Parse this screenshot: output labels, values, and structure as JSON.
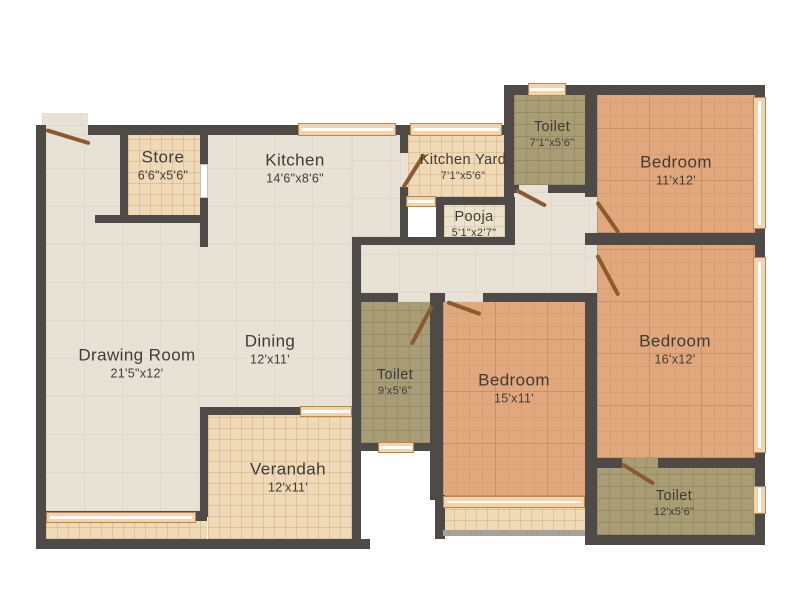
{
  "plan_title": "2BHK-style apartment floor plan",
  "rooms": [
    {
      "name": "Store",
      "dims": "6'6\"x5'6\""
    },
    {
      "name": "Kitchen",
      "dims": "14'6\"x8'6\""
    },
    {
      "name": "Kitchen Yard",
      "dims": "7'1\"x5'6\""
    },
    {
      "name": "Toilet",
      "dims": "7'1\"x5'6\""
    },
    {
      "name": "Bedroom",
      "dims": "11'x12'"
    },
    {
      "name": "Pooja",
      "dims": "5'1\"x2'7\""
    },
    {
      "name": "Drawing Room",
      "dims": "21'5\"x12'"
    },
    {
      "name": "Dining",
      "dims": "12'x11'"
    },
    {
      "name": "Toilet",
      "dims": "9'x5'6\""
    },
    {
      "name": "Bedroom",
      "dims": "15'x11'"
    },
    {
      "name": "Bedroom",
      "dims": "16'x12'"
    },
    {
      "name": "Verandah",
      "dims": "12'x11'"
    },
    {
      "name": "Toilet",
      "dims": "12'x5'6\""
    }
  ],
  "colors": {
    "wall": "#4e4a47",
    "living_floor": "#e7e2d5",
    "tile_floor": "#f0d9b6",
    "pooja_floor": "#ece3cd",
    "toilet_floor": "#a89d74",
    "bedroom_floor": "#e0a87c",
    "window": "#f6d3a7",
    "window_border": "#b5894f",
    "door": "#8a5a30",
    "text": "#3f3c38",
    "background": "#ffffff"
  }
}
